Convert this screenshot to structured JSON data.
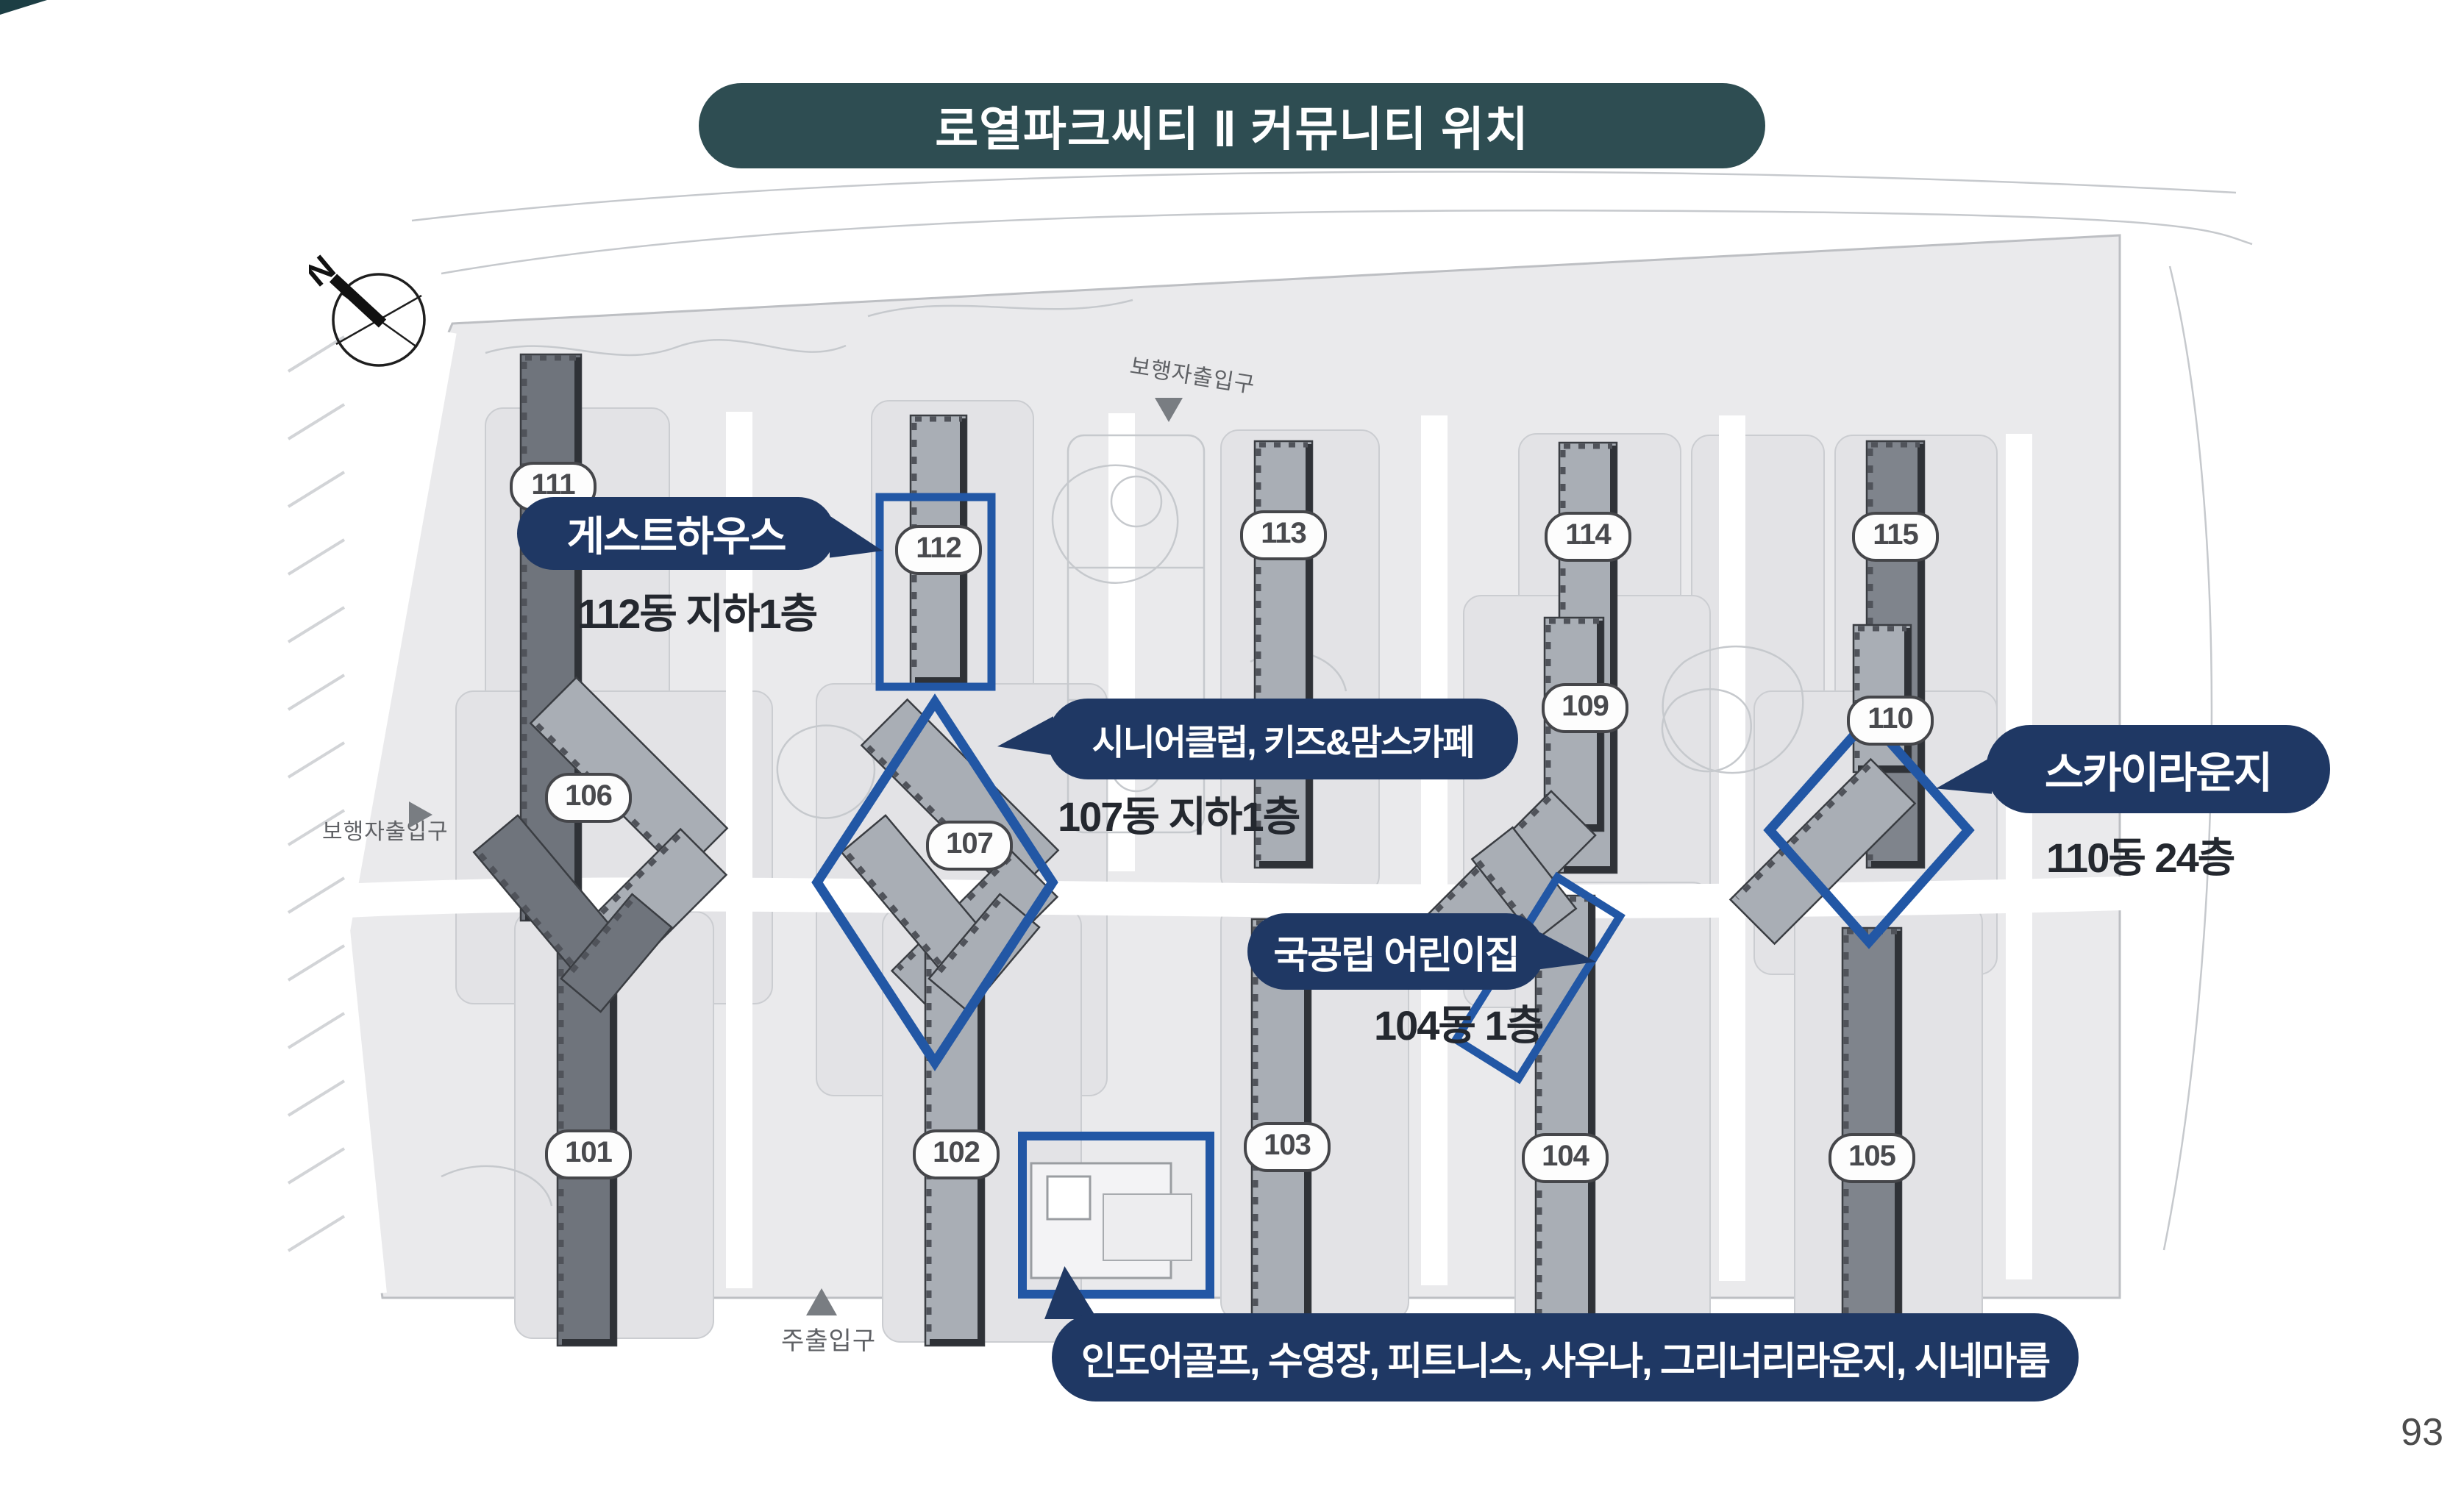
{
  "page": {
    "title": "로열파크씨티 Ⅱ 커뮤니티 위치",
    "number": "93"
  },
  "compass": {
    "north_label": "N"
  },
  "entrances": {
    "top": "보행자출입구",
    "left": "보행자출입구",
    "main": "주출입구"
  },
  "buildings": [
    {
      "number": "101"
    },
    {
      "number": "102"
    },
    {
      "number": "103"
    },
    {
      "number": "104"
    },
    {
      "number": "105"
    },
    {
      "number": "106"
    },
    {
      "number": "107"
    },
    {
      "number": "109"
    },
    {
      "number": "110"
    },
    {
      "number": "111"
    },
    {
      "number": "112"
    },
    {
      "number": "113"
    },
    {
      "number": "114"
    },
    {
      "number": "115"
    }
  ],
  "annotations": {
    "guesthouse": {
      "label": "게스트하우스",
      "location": "112동 지하1층"
    },
    "senior_kids_cafe": {
      "label": "시니어클럽, 키즈&맘스카페",
      "location": "107동 지하1층"
    },
    "sky_lounge": {
      "label": "스카이라운지",
      "location": "110동 24층"
    },
    "daycare": {
      "label": "국공립 어린이집",
      "location": "104동 1층"
    },
    "community_center": {
      "label": "인도어골프, 수영장, 피트니스, 사우나, 그리너리라운지, 시네마룸"
    }
  },
  "colors": {
    "title_bg": "#2E4D52",
    "bubble_bg": "#1F3864",
    "highlight_blue": "#2257A5",
    "location_text": "#24282F"
  }
}
